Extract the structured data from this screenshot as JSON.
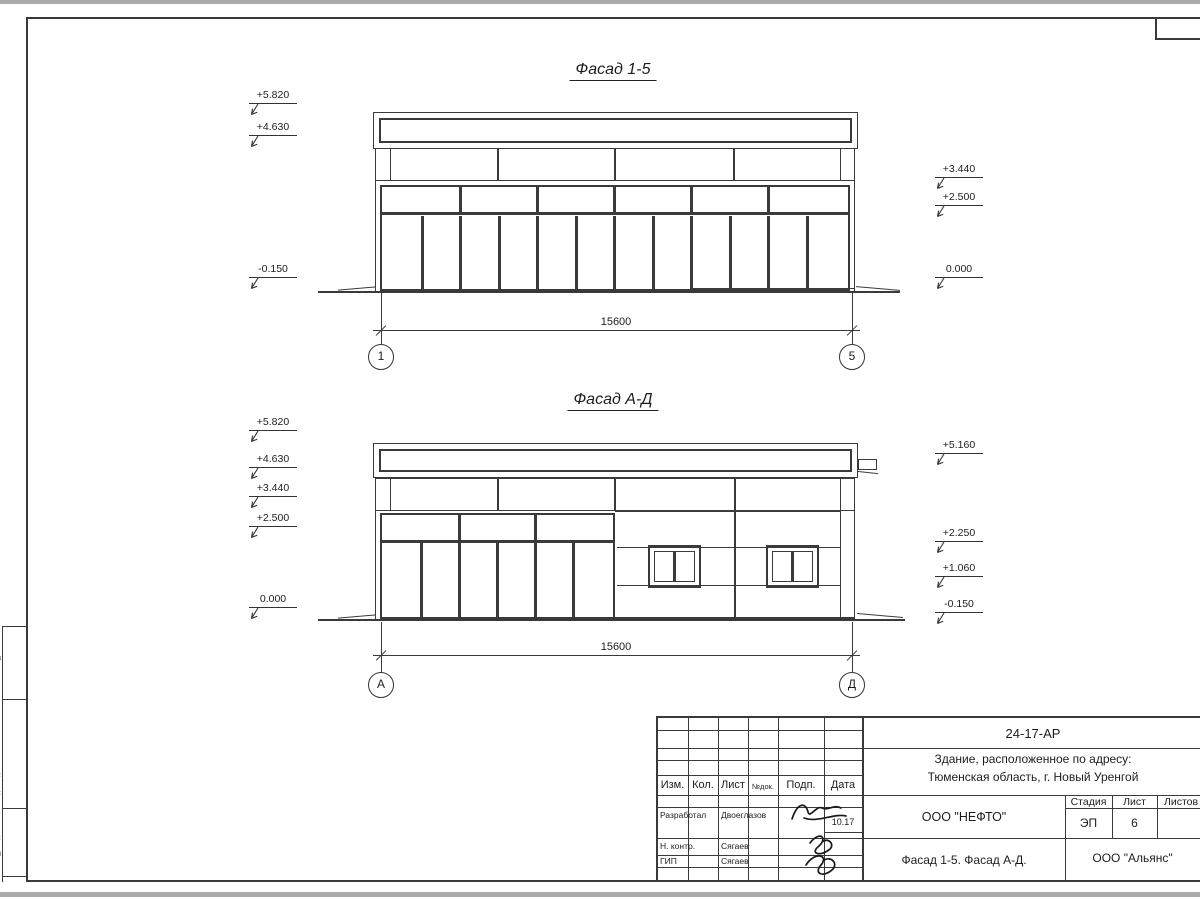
{
  "sheet": {
    "side_stamp": [
      "Взам. инв. №",
      "Подп. и дата",
      "Инв. № подл."
    ]
  },
  "facades": [
    {
      "title": "Фасад 1-5",
      "marks_left": [
        {
          "text": "+5.820",
          "y": 103
        },
        {
          "text": "+4.630",
          "y": 135
        },
        {
          "text": "-0.150",
          "y": 277
        }
      ],
      "marks_right": [
        {
          "text": "+3.440",
          "y": 177
        },
        {
          "text": "+2.500",
          "y": 205
        },
        {
          "text": "0.000",
          "y": 277
        }
      ],
      "dimension": {
        "label": "15600"
      },
      "axes": [
        {
          "label": "1"
        },
        {
          "label": "5"
        }
      ]
    },
    {
      "title": "Фасад А-Д",
      "marks_left": [
        {
          "text": "+5.820",
          "y": 430
        },
        {
          "text": "+4.630",
          "y": 467
        },
        {
          "text": "+3.440",
          "y": 496
        },
        {
          "text": "+2.500",
          "y": 526
        },
        {
          "text": "0.000",
          "y": 607
        }
      ],
      "marks_right": [
        {
          "text": "+5.160",
          "y": 453
        },
        {
          "text": "+2.250",
          "y": 541
        },
        {
          "text": "+1.060",
          "y": 576
        },
        {
          "text": "-0.150",
          "y": 612
        }
      ],
      "dimension": {
        "label": "15600"
      },
      "axes": [
        {
          "label": "А"
        },
        {
          "label": "Д"
        }
      ]
    }
  ],
  "title_block": {
    "code": "24-17-АР",
    "address": [
      "Здание, расположенное по адресу:",
      "Тюменская область, г. Новый Уренгой"
    ],
    "col_headers": [
      "Изм.",
      "Кол.",
      "Лист",
      "№док.",
      "Подп.",
      "Дата"
    ],
    "people": [
      {
        "role": "Разработал",
        "name": "Двоеглазов",
        "date": "10.17"
      },
      {
        "role": "Н. контр.",
        "name": "Сягаев",
        "date": ""
      },
      {
        "role": "ГИП",
        "name": "Сягаев",
        "date": ""
      }
    ],
    "company": "ООО \"НЕФТО\"",
    "stage_header": "Стадия",
    "sheet_header": "Лист",
    "sheets_header": "Листов",
    "stage": "ЭП",
    "sheet_no": "6",
    "sheets_total": "",
    "doc_title": "Фасад 1-5. Фасад А-Д.",
    "firm": "ООО \"Альянс\""
  }
}
